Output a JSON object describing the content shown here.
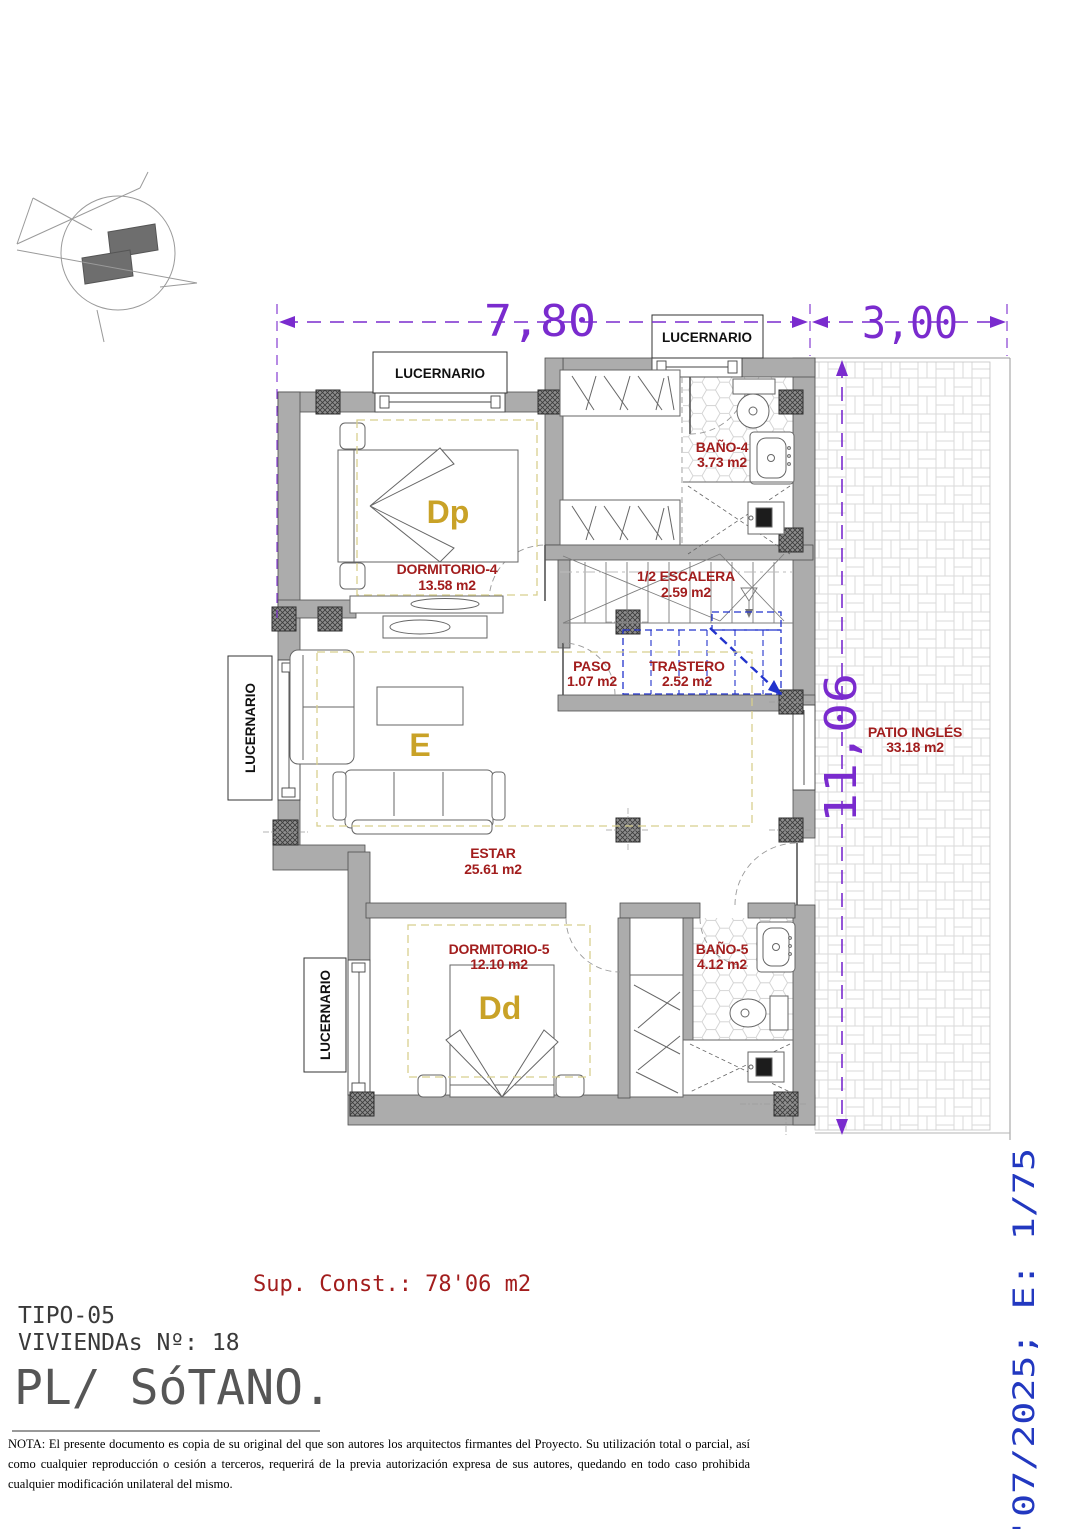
{
  "doc": {
    "dim_top": "7,80",
    "dim_patio": "3,00",
    "dim_side": "11,06",
    "skylight": "LUCERNARIO",
    "rooms": {
      "dorm4": {
        "name": "DORMITORIO-4",
        "area": "13.58 m2",
        "letter": "Dp"
      },
      "bano4": {
        "name": "BAÑO-4",
        "area": "3.73 m2"
      },
      "escalera": {
        "name": "1/2 ESCALERA",
        "area": "2.59 m2"
      },
      "paso": {
        "name": "PASO",
        "area": "1.07 m2"
      },
      "trastero": {
        "name": "TRASTERO",
        "area": "2.52 m2"
      },
      "estar": {
        "name": "ESTAR",
        "area": "25.61 m2",
        "letter": "E"
      },
      "dorm5": {
        "name": "DORMITORIO-5",
        "area": "12.10 m2",
        "letter": "Dd"
      },
      "bano5": {
        "name": "BAÑO-5",
        "area": "4.12 m2"
      },
      "patio": {
        "name": "PATIO INGLÉS",
        "area": "33.18 m2"
      }
    },
    "title": {
      "sup_const": "Sup. Const.: 78'06 m2",
      "tipo": "TIPO-05",
      "viviendas": "VIVIENDAs Nº: 18",
      "planta": "PL/ SóTANO."
    },
    "stamp": "'07/2025; E: 1/75",
    "nota": "NOTA: El presente documento es copia de su original del que son autores los arquitectos firmantes del Proyecto. Su utilización total o parcial, así como cualquier reproducción o cesión a terceros, requerirá  de la previa autorización expresa de sus autores, quedando en todo caso prohibida cualquier modificación unilateral del mismo."
  },
  "colors": {
    "dimension_purple": "#7A2BCE",
    "room_label_red": "#A21D1D",
    "room_letter_gold": "#C9A227",
    "stamp_blue": "#2238C0",
    "trastero_blue": "#2233CC",
    "wall_gray": "#ACACAC"
  }
}
